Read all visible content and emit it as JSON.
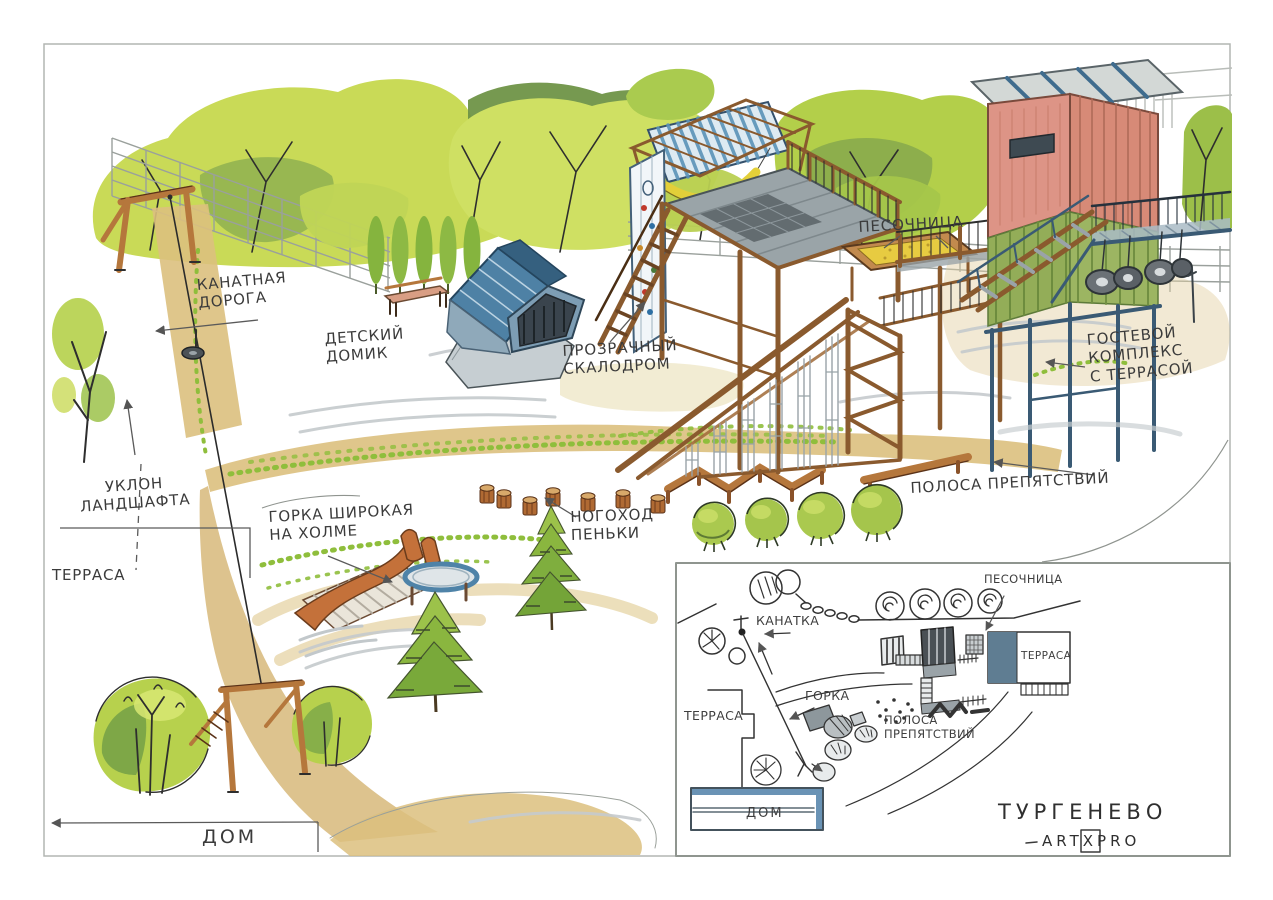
{
  "project": {
    "site_name": "ТУРГЕНЕВО",
    "studio": "ARTXPRO"
  },
  "annotations": {
    "cable_road": "КАНАТНАЯ\nДОРОГА",
    "kids_house": "ДЕТСКИЙ\nДОМИК",
    "transparent_climbing_wall": "ПРОЗРАЧНЫЙ\nСКАЛОДРОМ",
    "sandbox": "ПЕСОЧНИЦА",
    "guest_complex": "ГОСТЕВОЙ\nКОМПЛЕКС\nС ТЕРРАСОЙ",
    "landscape_slope": "УКЛОН\nЛАНДШАФТА",
    "terrace": "ТЕРРАСА",
    "wide_slide": "ГОРКА ШИРОКАЯ\nНА ХОЛМЕ",
    "stump_walk": "НОГОХОД\nПЕНЬКИ",
    "obstacle_course": "ПОЛОСА ПРЕПЯТСТВИЙ",
    "house": "ДОМ"
  },
  "inset_map": {
    "labels": {
      "sandbox": "ПЕСОЧНИЦА",
      "cableway": "КАНАТКА",
      "terrace_right": "ТЕРРАСА",
      "slide": "ГОРКА",
      "obstacle_course": "ПОЛОСА\nПРЕПЯТСТВИЙ",
      "terrace_left": "ТЕРРАСА",
      "house": "ДОМ"
    }
  },
  "palette": {
    "paper": "#ffffff",
    "ink": "#2e2e2e",
    "pencil": "#a9aeab",
    "foliage_light": "#cfe063",
    "foliage": "#b3cf4a",
    "foliage_dark": "#7fa23d",
    "olive": "#6f9447",
    "wood": "#b5773c",
    "wood_dark": "#8a5a2e",
    "path_tan": "#dcc07e",
    "sand": "#e7cb41",
    "roof_blue": "#4e81a5",
    "steel_blue": "#3a5a74",
    "stripe_blue": "#5b93b8",
    "building_pink": "#dd9486",
    "building_green": "#93ad58",
    "deck_gray": "#9aa4a8",
    "slide_orange": "#c4713a",
    "hammock_yellow": "#e3cf39"
  }
}
